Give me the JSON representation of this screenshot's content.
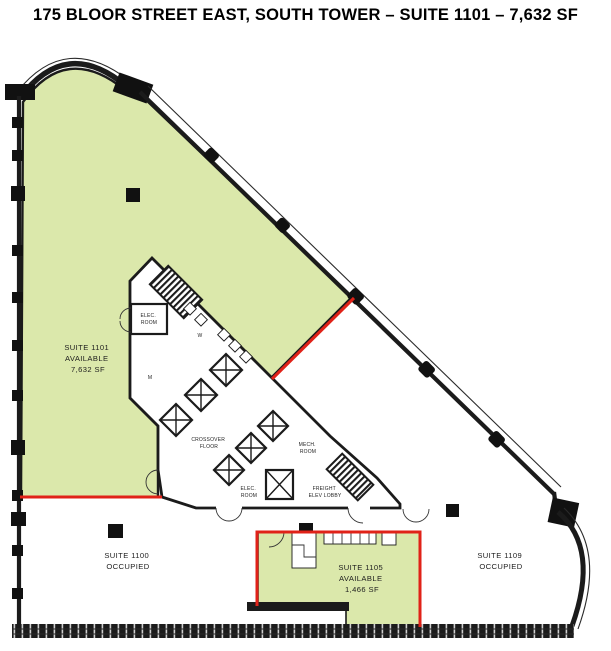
{
  "title": "175 BLOOR STREET EAST, SOUTH TOWER – SUITE 1101 – 7,632 SF",
  "suites": {
    "s1101": {
      "line1": "SUITE 1101",
      "line2": "AVAILABLE",
      "line3": "7,632 SF"
    },
    "s1100": {
      "line1": "SUITE 1100",
      "line2": "OCCUPIED"
    },
    "s1105": {
      "line1": "SUITE 1105",
      "line2": "AVAILABLE",
      "line3": "1,466 SF"
    },
    "s1109": {
      "line1": "SUITE 1109",
      "line2": "OCCUPIED"
    }
  },
  "core": {
    "elec_room_upper": {
      "line1": "ELEC.",
      "line2": "ROOM"
    },
    "elec_room_lower": {
      "line1": "ELEC.",
      "line2": "ROOM"
    },
    "crossover": {
      "line1": "CROSSOVER",
      "line2": "FLOOR"
    },
    "mech_room": {
      "line1": "MECH.",
      "line2": "ROOM"
    },
    "freight_lobby": {
      "line1": "FREIGHT",
      "line2": "ELEV LOBBY"
    },
    "washroom_women": "W",
    "washroom_men": "M"
  },
  "colors": {
    "available_green": "#dbe8ab",
    "boundary_red": "#e02218",
    "wall_dark": "#1b1b1b"
  }
}
